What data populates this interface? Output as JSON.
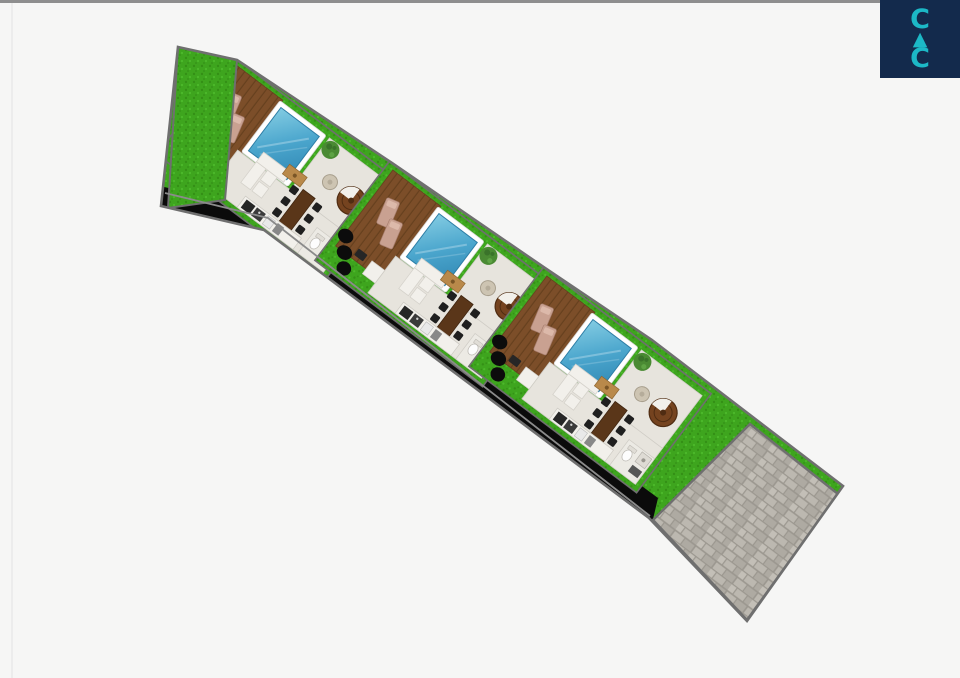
{
  "page": {
    "background": "#f6f6f5"
  },
  "logo": {
    "line1": "C",
    "line2": "▲",
    "line3": "C"
  },
  "site_plan": {
    "villa_count": 3,
    "villas": [
      {
        "id": "villa-1",
        "features": [
          "swimming pool",
          "wooden sun deck",
          "sun loungers",
          "living sofa",
          "dining table with chairs",
          "spiral staircase",
          "kitchen counter",
          "bathroom",
          "lawn",
          "shrubs"
        ]
      },
      {
        "id": "villa-2",
        "features": [
          "swimming pool",
          "wooden sun deck",
          "sun loungers",
          "living sofa",
          "dining table with chairs",
          "spiral staircase",
          "kitchen counter",
          "bathroom",
          "lawn",
          "shrubs"
        ]
      },
      {
        "id": "villa-3",
        "features": [
          "swimming pool",
          "wooden sun deck",
          "sun loungers",
          "living sofa",
          "dining table with chairs",
          "spiral staircase",
          "kitchen counter",
          "bathroom",
          "lawn",
          "shrubs"
        ]
      }
    ],
    "parking": "stone paved area",
    "landscape": "grass lawn strip with dark access band"
  },
  "colors": {
    "navy": "#132a4c",
    "teal": "#1cb8c6",
    "top-bar": "#8e8e8e",
    "left-line": "#ececec",
    "background": "#f6f6f5",
    "outline": "#6f6f6f",
    "grass": "#3ea51e",
    "grass-dark": "#349016",
    "grass-light": "#4cb92b",
    "shadow-band": "#0b0b0b",
    "boundary-line": "#8b8b8b",
    "deck": "#7c4e29",
    "deck-dark": "#66401e",
    "pool-border": "#ffffff",
    "pool-light": "#82cbe2",
    "pool-mid": "#4ba6cd",
    "pool-deep": "#3188b4",
    "pool-edge": "#2e7ea6",
    "floor": "#e7e4dd",
    "floor-edge": "#cfccc5",
    "white-furniture": "#f2f0eb",
    "furniture-edge": "#d5d2cb",
    "wood-table": "#5a3619",
    "chair": "#1f1f1f",
    "coffee-table": "#b9894a",
    "round-table": "#cdc4b2",
    "plant": "#4a8a33",
    "plant-dark": "#3a732a",
    "stair": "#75431f",
    "stair-dark": "#4f2c12",
    "lounger": "#c9a191",
    "lounger-edge": "#a87f6f",
    "appliance": "#262626",
    "bush": "#0c0c0c",
    "stone-gap": "#9b978f",
    "stone-a": "#bcb8b0",
    "stone-b": "#aeaaa2",
    "stone-c": "#c3bfb7",
    "bathroom-floor": "#eceae4",
    "shower": "#dedbd4",
    "mat": "#565656"
  }
}
